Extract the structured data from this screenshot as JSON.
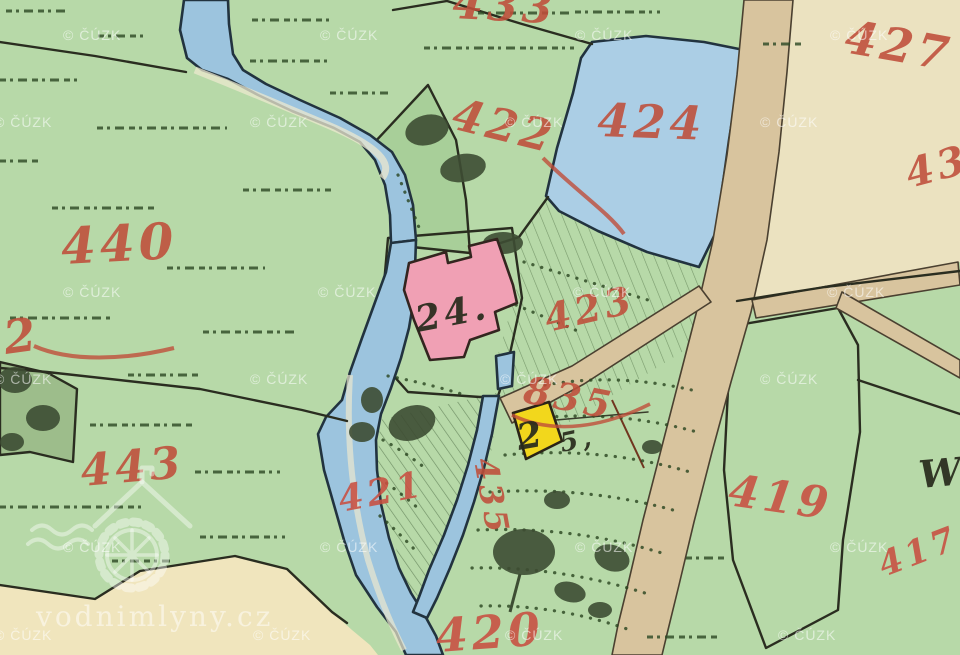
{
  "map": {
    "kind": "historical cadastral map tile",
    "provider_watermark": "© ČÚZK",
    "site_watermark": "vodnimlyny.cz",
    "palette": {
      "field_green": "#b7d9a8",
      "woodland_green": "#a8cf99",
      "dark_garden_green": "#9dbd8b",
      "water_blue": "#9cc4de",
      "pond_blue": "#abcee5",
      "road_tan": "#d8c49e",
      "parcel_cream": "#ebe2c0",
      "parcel_cream_bright": "#f0ead3",
      "parcel_cream_warm": "#f0e5bd",
      "courtyard_white": "#efecdc",
      "building_masonry_pink": "#f0a0b4",
      "building_wood_yellow": "#f2d71c",
      "label_red": "#bf4e3a",
      "ink_black": "#2a2d20"
    },
    "parcel_labels": {
      "p433": "433",
      "p427": "427",
      "p424": "424",
      "p422": "422",
      "p440": "440",
      "p442": "2",
      "p443": "443",
      "p423": "423",
      "p835": "835",
      "p421": "421",
      "p435": "435",
      "p420": "420",
      "p419": "419",
      "p417": "417",
      "p43": "43",
      "letter_w": "W"
    },
    "building_labels": {
      "house_24": "24.",
      "house_2": "2",
      "mark_5": "5,"
    }
  }
}
